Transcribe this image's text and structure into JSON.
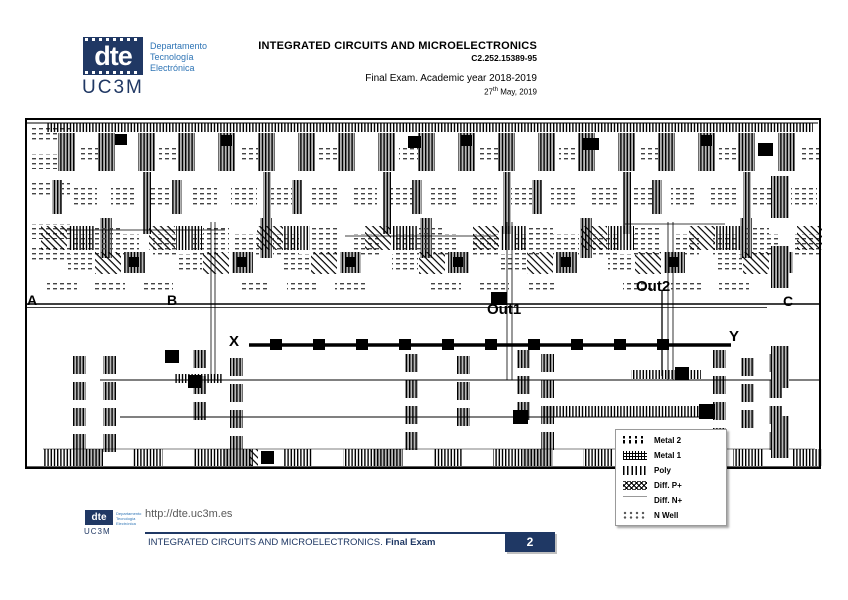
{
  "header": {
    "logo": {
      "acronym": "dte",
      "dept_lines": [
        "Departamento",
        "Tecnología",
        "Electrónica"
      ],
      "university": "UC3M"
    },
    "course_title": "INTEGRATED CIRCUITS AND MICROELECTRONICS",
    "course_code": "C2.252.15389-95",
    "exam_line": "Final Exam. Academic year 2018-2019",
    "date_day": "27",
    "date_suffix": "th",
    "date_rest": " May, 2019"
  },
  "diagram": {
    "labels": {
      "a": "A",
      "b": "B",
      "c": "C",
      "x": "X",
      "y": "Y",
      "out1": "Out1",
      "out2": "Out2"
    },
    "legend": {
      "items": [
        {
          "label": "Metal 2"
        },
        {
          "label": "Metal 1"
        },
        {
          "label": "Poly"
        },
        {
          "label": "Diff. P+"
        },
        {
          "label": "Diff. N+"
        },
        {
          "label": "N Well"
        }
      ]
    }
  },
  "footer": {
    "logo": {
      "acronym": "dte",
      "dept_lines": [
        "Departamento",
        "Tecnología",
        "Electrónica"
      ],
      "university": "UC3M"
    },
    "url": "http://dte.uc3m.es",
    "bar_title": "INTEGRATED CIRCUITS AND MICROELECTRONICS. ",
    "bar_title_bold": "Final Exam",
    "page_number": "2"
  },
  "colors": {
    "navy": "#1f3864",
    "brand_blue": "#2e74b5",
    "text_gray": "#595959",
    "layout_ink": "#000000"
  }
}
